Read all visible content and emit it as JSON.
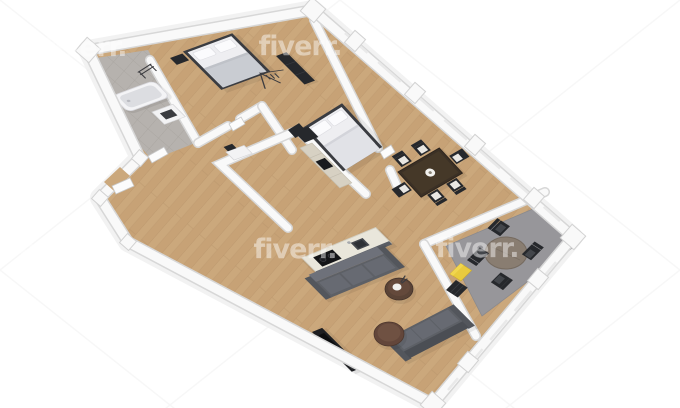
{
  "scene": {
    "kind": "3d-floor-plan-render",
    "view": "top-down-isometric"
  },
  "watermark": {
    "text": "fiverr.",
    "color": "#ffffff",
    "opacity": 0.45
  },
  "palette": {
    "background": "#ffffff",
    "floor_wood": "#cba87c",
    "floor_wood_seam": "#b8946a",
    "wall_fill": "#f9f9f9",
    "wall_edge": "#d7d7d7",
    "bath_tile": "#b6b2ae",
    "bath_tile_line": "#a7a39e",
    "office_rug": "#97969a",
    "sofa_gray": "#5d6066",
    "bed_frame": "#3a3c41",
    "mattress_white": "#eeeef1",
    "blanket_gray": "#c9ccd2",
    "dining_wood": "#3b3025",
    "office_table_brown": "#897d71",
    "coffee_table_brown": "#5a4336",
    "dark_furniture": "#26282c",
    "cabinet_beige": "#d7d1c3",
    "island_top": "#e9e6db",
    "accent_yellow": "#e9cb3e",
    "chair_dark": "#2b2d31",
    "watermark_color": "#ffffff"
  },
  "rooms": [
    {
      "name": "bathroom"
    },
    {
      "name": "bedroom"
    },
    {
      "name": "hallway"
    },
    {
      "name": "master-bedroom"
    },
    {
      "name": "closet"
    },
    {
      "name": "kitchen"
    },
    {
      "name": "dining-area"
    },
    {
      "name": "home-office"
    },
    {
      "name": "living-room"
    },
    {
      "name": "entry"
    }
  ],
  "furniture": [
    "bathtub",
    "washing-machine",
    "towel-rack",
    "double-bed",
    "nightstand",
    "wardrobe",
    "clothes-rack",
    "closet-dresser",
    "kitchen-cabinets",
    "kitchen-tall-unit",
    "kitchen-island",
    "cooktop",
    "sink",
    "dining-table",
    "dining-chair",
    "office-table",
    "office-chair",
    "office-rug",
    "sofa",
    "coffee-table",
    "tv-console",
    "yellow-cabinet",
    "shelf-unit",
    "door"
  ]
}
